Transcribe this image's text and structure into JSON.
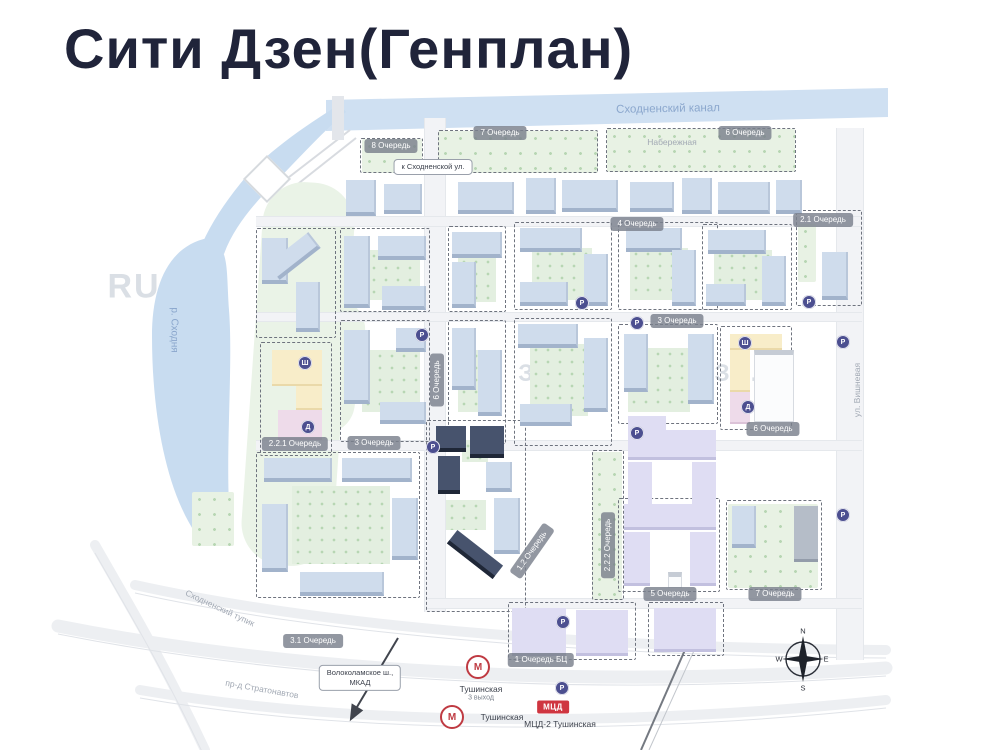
{
  "title": "Сити Дзен(Генплан)",
  "map": {
    "phase_badges": [
      {
        "text": "8 Очередь",
        "x": 391,
        "y": 146
      },
      {
        "text": "7 Очередь",
        "x": 500,
        "y": 133
      },
      {
        "text": "6 Очередь",
        "x": 745,
        "y": 133
      },
      {
        "text": "4 Очередь",
        "x": 637,
        "y": 224
      },
      {
        "text": "2.1 Очередь",
        "x": 823,
        "y": 220
      },
      {
        "text": "3 Очередь",
        "x": 677,
        "y": 321
      },
      {
        "text": "6 Очередь",
        "x": 437,
        "y": 380,
        "rot": -90
      },
      {
        "text": "2.2.1 Очередь",
        "x": 295,
        "y": 444
      },
      {
        "text": "3 Очередь",
        "x": 374,
        "y": 443
      },
      {
        "text": "1.2 Очередь",
        "x": 532,
        "y": 551,
        "rot": -55
      },
      {
        "text": "2.2.2 Очередь",
        "x": 608,
        "y": 545,
        "rot": -90
      },
      {
        "text": "6 Очередь",
        "x": 773,
        "y": 429
      },
      {
        "text": "5 Очередь",
        "x": 670,
        "y": 594
      },
      {
        "text": "7 Очередь",
        "x": 775,
        "y": 594
      },
      {
        "text": "3.1 Очередь",
        "x": 313,
        "y": 641
      },
      {
        "text": "1 Очередь БЦ",
        "x": 541,
        "y": 660
      }
    ],
    "street_labels": [
      {
        "name": "canal-label",
        "text": "Сходненский канал",
        "x": 668,
        "y": 109,
        "rot": -1,
        "cls": "canal-label"
      },
      {
        "name": "river-label",
        "text": "р. Сходня",
        "x": 174,
        "y": 330,
        "rot": 90,
        "cls": "river-label"
      },
      {
        "name": "street-naberezhnaya",
        "text": "Набережная",
        "x": 672,
        "y": 142,
        "rot": 0,
        "cls": "street"
      },
      {
        "name": "street-vishnevaya",
        "text": "ул. Вишневая",
        "x": 857,
        "y": 390,
        "rot": -90,
        "cls": "street"
      },
      {
        "name": "street-skhodnensky-tupik",
        "text": "Сходненский тупик",
        "x": 220,
        "y": 608,
        "rot": 25,
        "cls": "street"
      },
      {
        "name": "street-stratonavtov",
        "text": "пр-д Стратонавтов",
        "x": 262,
        "y": 689,
        "rot": 10,
        "cls": "street"
      }
    ],
    "signs": [
      {
        "name": "sign-to-skhodnenskaya",
        "lines": [
          "к Сходненской ул."
        ],
        "x": 433,
        "y": 167
      },
      {
        "name": "sign-volokolamskoe-mkad",
        "lines": [
          "Волоколамское ш.,",
          "МКАД"
        ],
        "x": 360,
        "y": 678
      }
    ],
    "watermarks": [
      {
        "text": "RU",
        "x": 134,
        "y": 287,
        "size": 34
      },
      {
        "text": "ЗД.RU",
        "x": 560,
        "y": 374,
        "size": 24
      },
      {
        "text": "ЗД.",
        "x": 737,
        "y": 374,
        "size": 24
      }
    ],
    "poi": [
      {
        "name": "school-icon",
        "glyph": "Ш",
        "x": 305,
        "y": 363
      },
      {
        "name": "kindergarten-icon",
        "glyph": "Д",
        "x": 308,
        "y": 427
      },
      {
        "name": "school-icon",
        "glyph": "Ш",
        "x": 745,
        "y": 343
      },
      {
        "name": "kindergarten-icon",
        "glyph": "Д",
        "x": 748,
        "y": 407
      },
      {
        "name": "parking-icon",
        "glyph": "P",
        "x": 422,
        "y": 335
      },
      {
        "name": "parking-icon",
        "glyph": "P",
        "x": 433,
        "y": 447
      },
      {
        "name": "parking-icon",
        "glyph": "P",
        "x": 582,
        "y": 303
      },
      {
        "name": "parking-icon",
        "glyph": "P",
        "x": 637,
        "y": 323
      },
      {
        "name": "parking-icon",
        "glyph": "P",
        "x": 809,
        "y": 302
      },
      {
        "name": "parking-icon",
        "glyph": "P",
        "x": 843,
        "y": 342
      },
      {
        "name": "parking-icon",
        "glyph": "P",
        "x": 843,
        "y": 515
      },
      {
        "name": "parking-icon",
        "glyph": "P",
        "x": 637,
        "y": 433
      },
      {
        "name": "parking-icon",
        "glyph": "P",
        "x": 563,
        "y": 622
      },
      {
        "name": "parking-icon",
        "glyph": "P",
        "x": 562,
        "y": 688
      }
    ],
    "transit": {
      "metro_letter": "М",
      "stations": [
        {
          "label": "Тушинская",
          "sublabel": "3 выход"
        },
        {
          "label": "Тушинская"
        }
      ],
      "mcd_badge": "МЦД",
      "mcd_label": "МЦД-2 Тушинская"
    },
    "compass": {
      "north": "N",
      "east": "E",
      "south": "S",
      "west": "W"
    }
  }
}
